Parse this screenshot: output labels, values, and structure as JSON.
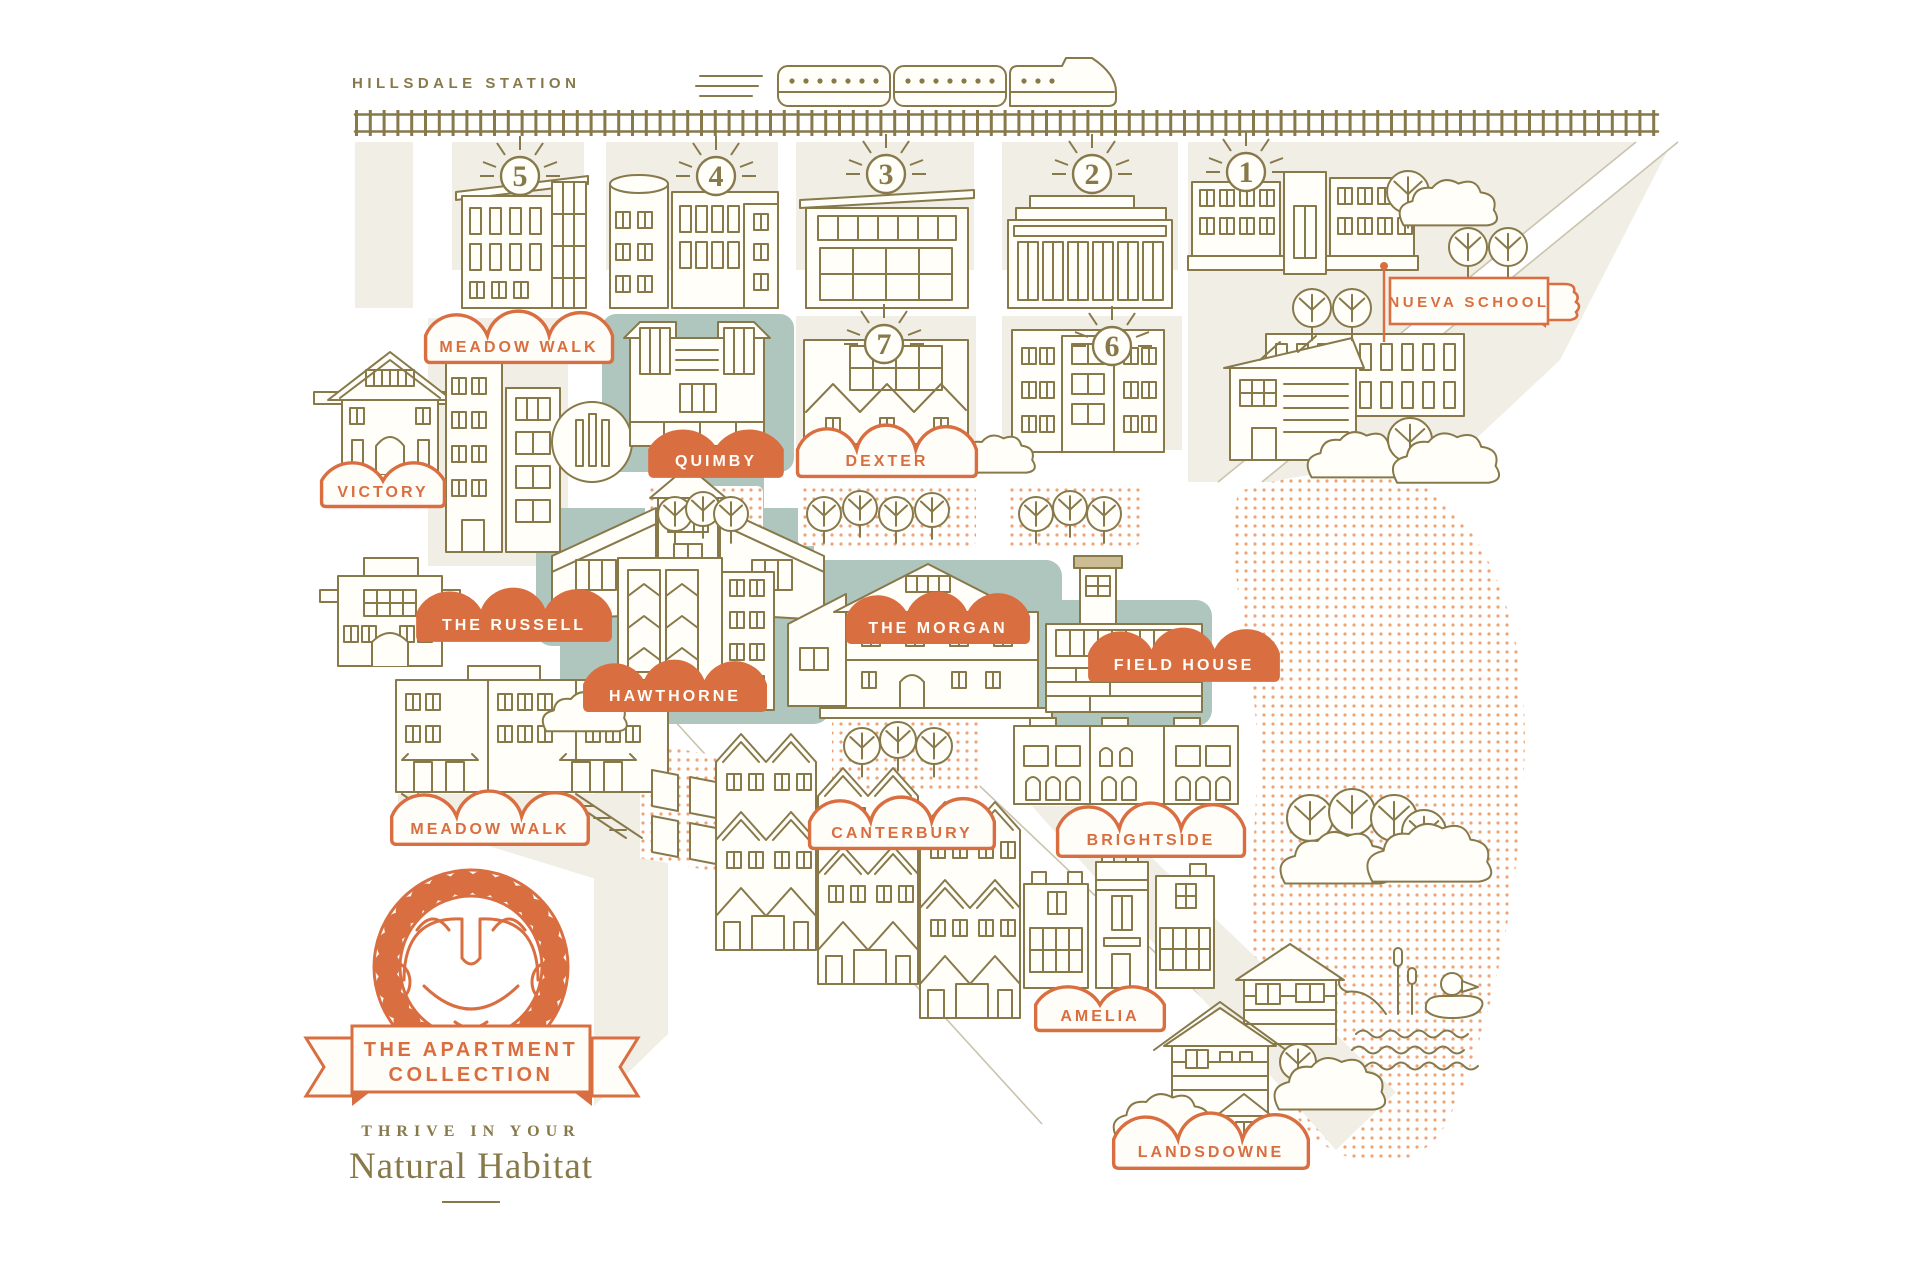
{
  "poster": {
    "station_label": "HILLSDALE STATION",
    "school_label": "NUEVA SCHOOL",
    "badges": {
      "b1": "1",
      "b2": "2",
      "b3": "3",
      "b4": "4",
      "b5": "5",
      "b6": "6",
      "b7": "7"
    },
    "labels": {
      "meadow_walk_north": "MEADOW WALK",
      "victory": "VICTORY",
      "quimby": "QUIMBY",
      "dexter": "DEXTER",
      "the_russell": "THE RUSSELL",
      "hawthorne": "HAWTHORNE",
      "the_morgan": "THE MORGAN",
      "field_house": "FIELD HOUSE",
      "meadow_walk_south": "MEADOW WALK",
      "canterbury": "CANTERBURY",
      "brightside": "BRIGHTSIDE",
      "amelia": "AMELIA",
      "landsdowne": "LANDSDOWNE"
    },
    "logo": {
      "title_line1": "THE APARTMENT",
      "title_line2": "COLLECTION",
      "tagline": "THRIVE IN YOUR",
      "subtitle": "Natural Habitat"
    },
    "colors": {
      "accent_orange": "#D96E41",
      "line_olive": "#87794A",
      "teal_block": "#AFC6BE",
      "panel_beige": "#F1EEE6",
      "park_dot": "#F0A474"
    }
  }
}
